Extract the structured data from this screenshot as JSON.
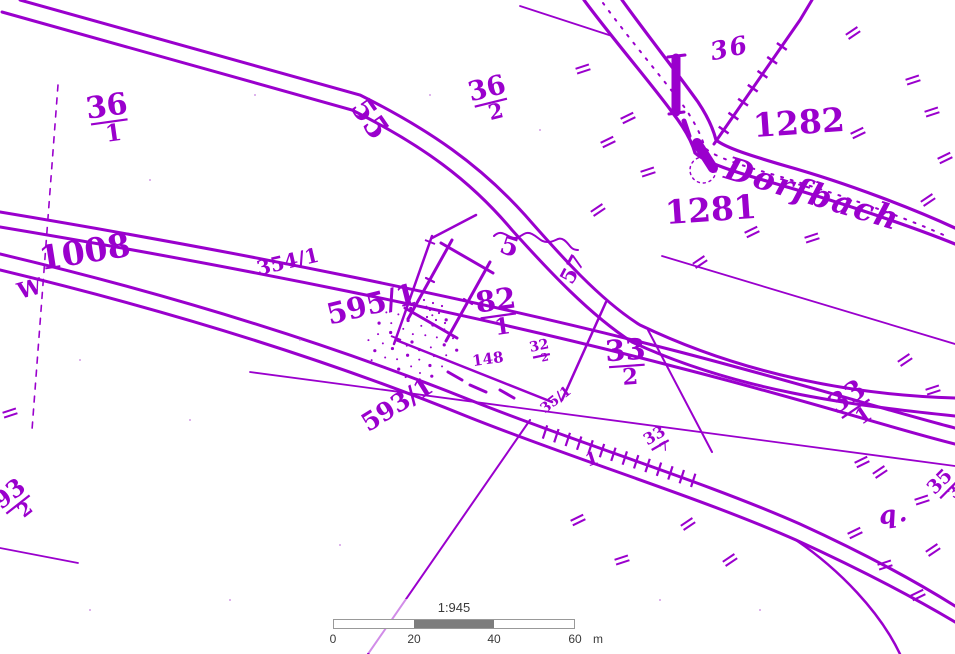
{
  "meta": {
    "description": "Scanned historical cadastral map, purple ink on white",
    "stream_name": "Dorfbach"
  },
  "colors": {
    "ink": "#9a00cd",
    "ink_soft": "#c77fe0",
    "scalebar_fill": "#7d7d7d",
    "scalebar_border": "#999999",
    "scalebar_text": "#3a3a3a"
  },
  "map": {
    "labels": [
      {
        "name": "parcel-36-1",
        "text": "36/1",
        "frac": true,
        "x": 108,
        "y": 116,
        "rot": -8,
        "size": 30
      },
      {
        "name": "parcel-1008",
        "text": "1008",
        "x": 85,
        "y": 254,
        "rot": -9,
        "size": 33
      },
      {
        "name": "marker-w",
        "text": "W",
        "x": 30,
        "y": 290,
        "rot": -15,
        "size": 22
      },
      {
        "name": "parcel-595-1",
        "text": "595/1",
        "x": 372,
        "y": 306,
        "rot": -14,
        "size": 29
      },
      {
        "name": "parcel-354-1",
        "text": "354/1",
        "x": 288,
        "y": 263,
        "rot": -13,
        "size": 20
      },
      {
        "name": "parcel-55",
        "text": "55",
        "x": 368,
        "y": 120,
        "rot": 55,
        "size": 30
      },
      {
        "name": "parcel-36-2",
        "text": "36/2",
        "frac": true,
        "x": 489,
        "y": 97,
        "rot": -14,
        "size": 27
      },
      {
        "name": "parcel-36",
        "text": "36",
        "script": true,
        "x": 730,
        "y": 50,
        "rot": -12,
        "size": 25
      },
      {
        "name": "parcel-1282",
        "text": "1282",
        "x": 799,
        "y": 125,
        "rot": -4,
        "size": 33
      },
      {
        "name": "parcel-1281",
        "text": "1281",
        "x": 711,
        "y": 212,
        "rot": -4,
        "size": 33
      },
      {
        "name": "stream-name",
        "text": "Dorfbach",
        "script": true,
        "x": 812,
        "y": 196,
        "rot": 17,
        "size": 32
      },
      {
        "name": "symbol-5",
        "text": "5",
        "x": 509,
        "y": 248,
        "rot": 18,
        "size": 26
      },
      {
        "name": "symbol-57",
        "text": "57",
        "x": 574,
        "y": 270,
        "rot": -62,
        "size": 21
      },
      {
        "name": "parcel-82-1",
        "text": "82/1",
        "frac": true,
        "x": 497,
        "y": 310,
        "rot": -8,
        "size": 29
      },
      {
        "name": "parcel-32-2",
        "text": "32/2",
        "frac": true,
        "x": 540,
        "y": 350,
        "rot": -12,
        "size": 14
      },
      {
        "name": "parcel-148",
        "text": "148",
        "x": 488,
        "y": 360,
        "rot": -8,
        "size": 15
      },
      {
        "name": "parcel-33-2",
        "text": "33/2",
        "frac": true,
        "x": 626,
        "y": 360,
        "rot": -4,
        "size": 29
      },
      {
        "name": "parcel-593-1",
        "text": "593/1",
        "x": 398,
        "y": 406,
        "rot": -32,
        "size": 25
      },
      {
        "name": "parcel-35-1",
        "text": "35/1",
        "x": 556,
        "y": 400,
        "rot": -38,
        "size": 14
      },
      {
        "name": "parcel-33-7",
        "text": "33/7",
        "frac": true,
        "x": 657,
        "y": 440,
        "rot": -30,
        "size": 16
      },
      {
        "name": "symbol-1",
        "text": "1",
        "x": 592,
        "y": 460,
        "rot": -18,
        "size": 18
      },
      {
        "name": "parcel-33-1",
        "text": "33/1",
        "frac": true,
        "x": 852,
        "y": 404,
        "rot": -34,
        "size": 27
      },
      {
        "name": "letter-q",
        "text": "q.",
        "script": true,
        "x": 894,
        "y": 516,
        "rot": -8,
        "size": 25
      },
      {
        "name": "parcel-35-3",
        "text": "35/3",
        "frac": true,
        "x": 944,
        "y": 486,
        "rot": -45,
        "size": 19
      },
      {
        "name": "parcel-93-2",
        "text": "93/2",
        "frac": true,
        "x": 14,
        "y": 500,
        "rot": -38,
        "size": 24
      }
    ]
  },
  "scalebar": {
    "ratio_label": "1:945",
    "tick_labels": [
      "0",
      "20",
      "40",
      "60"
    ],
    "unit_label": "m"
  }
}
